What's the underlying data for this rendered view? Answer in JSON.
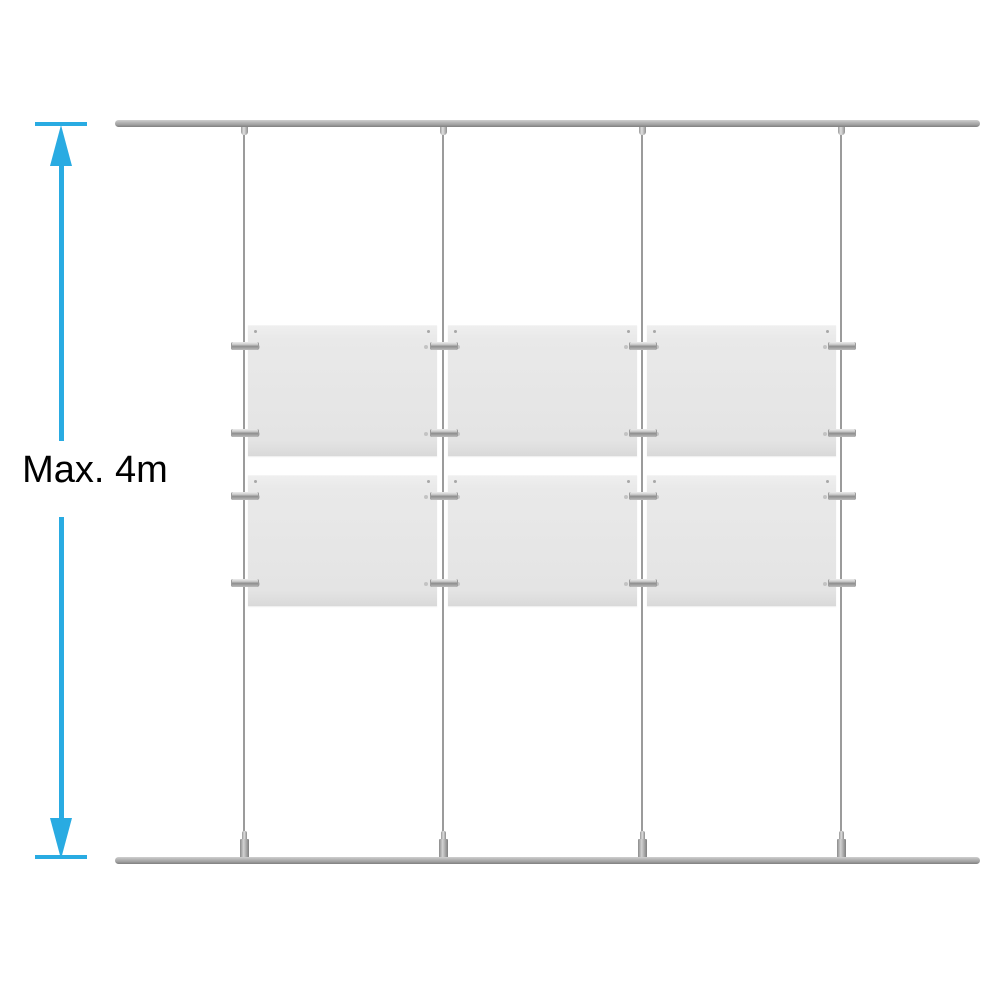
{
  "diagram_title": "cable-suspended-poster-display-system",
  "dimension": {
    "label": "Max. 4m",
    "color": "#29ABE2",
    "text_color": "#000000"
  },
  "system": {
    "rails": {
      "count": 2,
      "positions": [
        "top",
        "bottom"
      ],
      "color_light": "#cfcfcf",
      "color_mid": "#a2a2a2",
      "color_dark": "#7f7f7f"
    },
    "cables": {
      "count": 4,
      "centers_x": [
        244,
        443,
        642,
        841
      ],
      "color": "#9b9b9b"
    },
    "pockets": {
      "count": 6,
      "rows": 2,
      "columns": 3,
      "col_x": [
        248,
        448,
        647
      ],
      "row_y": [
        325,
        475
      ],
      "width": 189,
      "height": 130,
      "color": "#e9e9e9",
      "edge_color": "#d9d9d9"
    },
    "clamps": {
      "count": 16,
      "row_center_offsets_y": [
        21,
        108
      ],
      "width": 26,
      "height": 8,
      "color_light": "#ececec",
      "color_dark": "#8d8d8d"
    }
  }
}
